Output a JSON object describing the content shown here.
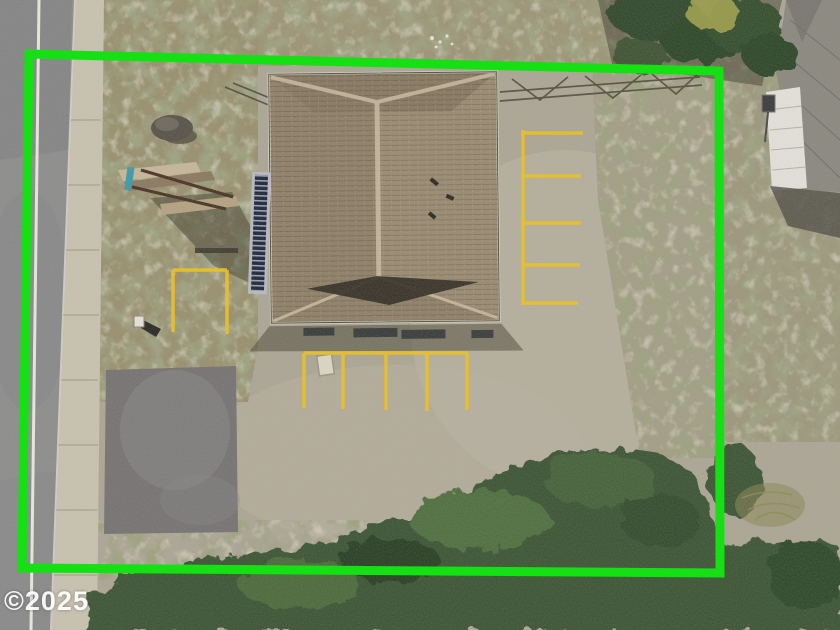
{
  "watermark": {
    "text": "©2025"
  },
  "colors": {
    "boundary_green": "#14e014",
    "marking_yellow": "#e7c02c",
    "watermark_white": "#ffffff",
    "roof_brown": "#8f8068",
    "roof_ridge_cap": "#cbbda2",
    "roof_valley_shadow": "#332e25",
    "road_asphalt": "#8d8d8d",
    "road_line_white": "#e9e7df",
    "sidewalk_concrete": "#c9c2b1",
    "grass_olive": "#9b9274",
    "gravel_light": "#b3ad9c",
    "asphalt_patch_gray": "#7b7878",
    "shrub_green": "#3d5534"
  },
  "scene": {
    "description": "Overhead aerial photo of a single hip-roof building on a gravel lot; property perimeter outlined in bright green; yellow parking stripes east and south of the building; street and sidewalk along the west edge; dense shrubs across the south; neighboring gray-roof house at the northeast corner.",
    "elements": [
      {
        "name": "property-boundary",
        "kind": "bright green overlay outline of the parcel"
      },
      {
        "name": "main-building-roof",
        "kind": "brown shingled hip roof, center of lot"
      },
      {
        "name": "exterior-stairs",
        "kind": "dark stairway along west wall of building"
      },
      {
        "name": "monument-sign",
        "kind": "wooden sign structure with teal post, casts shadow"
      },
      {
        "name": "boulder",
        "kind": "landscape rock near northwest grass"
      },
      {
        "name": "mailbox",
        "kind": "small white box by sidewalk"
      },
      {
        "name": "parking-lines-east",
        "kind": "five yellow striped stalls east of building"
      },
      {
        "name": "parking-lines-south",
        "kind": "four yellow striped stalls south of building"
      },
      {
        "name": "parking-stall-west",
        "kind": "single yellow stall outline in west grass"
      },
      {
        "name": "utility-box",
        "kind": "small pale box at south stripe"
      },
      {
        "name": "road",
        "kind": "asphalt street with white edge line, west side"
      },
      {
        "name": "sidewalk",
        "kind": "concrete walk with expansion joints"
      },
      {
        "name": "asphalt-driveway-patch",
        "kind": "dark paved apron, southwest"
      },
      {
        "name": "fence-north",
        "kind": "split-rail fence line north of building"
      },
      {
        "name": "neighbor-house",
        "kind": "gray shingle roof and white deck, northeast corner"
      },
      {
        "name": "trees-northeast",
        "kind": "tree canopy and shadows, top right"
      },
      {
        "name": "shrubs-south",
        "kind": "dense green vegetation across bottom"
      },
      {
        "name": "dry-brush",
        "kind": "dry branch and grass outside southeast boundary"
      },
      {
        "name": "watermark",
        "kind": "photo copyright text overlay"
      }
    ]
  }
}
